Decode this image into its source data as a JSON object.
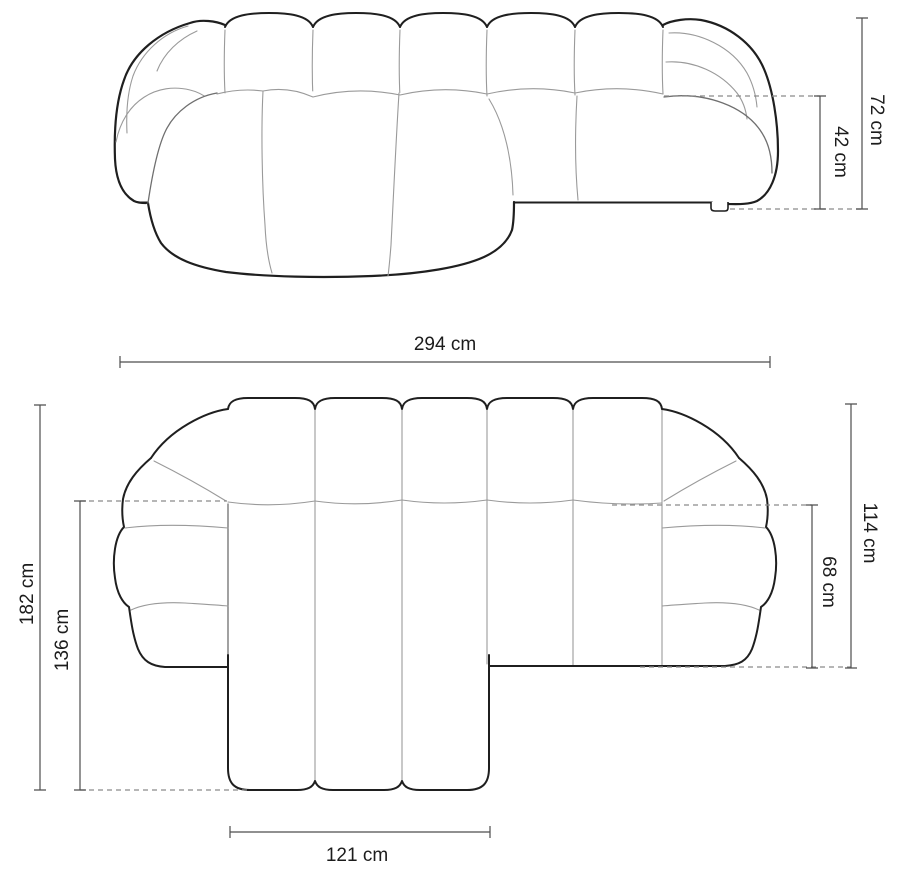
{
  "diagram": {
    "subject": "corner-sofa-dimension-drawing",
    "unit": "cm",
    "colors": {
      "background": "#ffffff",
      "outline": "#1f1f1f",
      "seam": "#9a9a9a",
      "dimension_line": "#4d4d4d",
      "dashed_line": "#8a8a8a",
      "label_text": "#1c1c1c"
    },
    "side_view": {
      "total_height": {
        "label": "72 cm",
        "value": 72,
        "unit": "cm"
      },
      "seat_height": {
        "label": "42 cm",
        "value": 42,
        "unit": "cm"
      },
      "total_width": {
        "label": "294 cm",
        "value": 294,
        "unit": "cm"
      }
    },
    "top_view": {
      "total_depth": {
        "label": "182 cm",
        "value": 182,
        "unit": "cm"
      },
      "chaise_depth": {
        "label": "136 cm",
        "value": 136,
        "unit": "cm"
      },
      "body_depth": {
        "label": "114 cm",
        "value": 114,
        "unit": "cm"
      },
      "inner_depth": {
        "label": "68 cm",
        "value": 68,
        "unit": "cm"
      },
      "chaise_width": {
        "label": "121 cm",
        "value": 121,
        "unit": "cm"
      }
    }
  }
}
